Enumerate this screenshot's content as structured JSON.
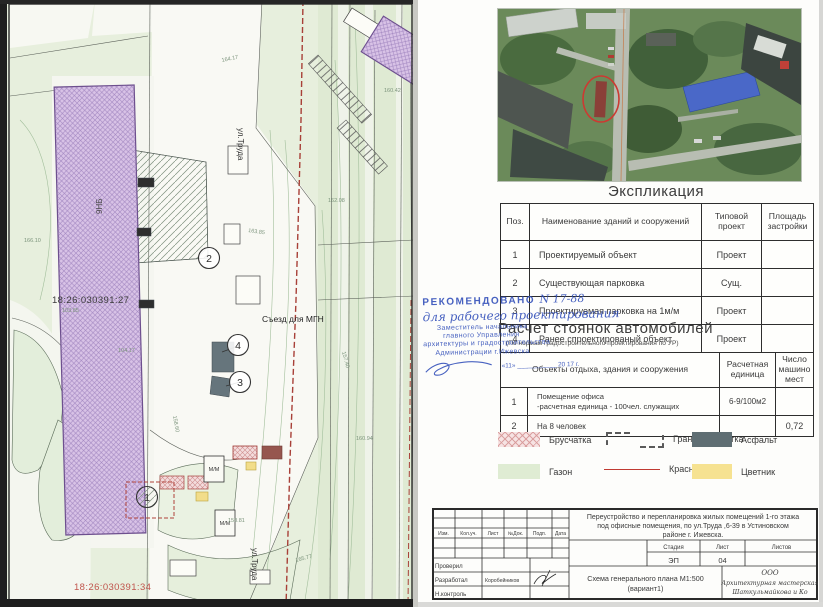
{
  "map": {
    "cadastral_number_left": "18:26:030391:27",
    "cadastral_number_bottom": "18:26:030391:34",
    "street_label": "ул.Труда",
    "street_label_2": "ул.Труда",
    "building_label": "9НБ",
    "ramp_label": "Съезд для МГН",
    "parking_space_label": "М/М",
    "parking_space_label_2": "М/М",
    "callout_1": "1",
    "callout_2": "2",
    "callout_3": "3",
    "callout_4": "4",
    "elevations": [
      "164.17",
      "163.85",
      "162.08",
      "157.40",
      "160.94",
      "158.60",
      "165.77",
      "104.17",
      "103.85",
      "158.81",
      "160.42",
      "166.10"
    ]
  },
  "explication": {
    "title": "Экспликация",
    "headers": [
      "Поз.",
      "Наименование зданий и сооружений",
      "Типовой проект",
      "Площадь застройки"
    ],
    "rows": [
      {
        "pos": "1",
        "name": "Проектируемый объект",
        "type": "Проект",
        "area": ""
      },
      {
        "pos": "2",
        "name": "Существующая парковка",
        "type": "Сущ.",
        "area": ""
      },
      {
        "pos": "3",
        "name": "Проектируемая парковка на 1м/м",
        "type": "Проект",
        "area": ""
      },
      {
        "pos": "4",
        "name": "Ранее спроектированый объект",
        "type": "Проект",
        "area": ""
      }
    ]
  },
  "approval_stamp": {
    "recommended": "РЕКОМЕНДОВАНО",
    "number": "N 17-88",
    "handwritten": "для рабочего проектирования",
    "line1": "Заместитель начальника",
    "line2": "главного Управления",
    "line3": "архитектуры и градостроительства",
    "line4": "Администрации г.Ижевска",
    "date_line": "«11» ___________ 20 17 г."
  },
  "parking_calc": {
    "title": "Расчет стоянок автомобилей",
    "subtitle": "(По нормам градостроительного проектирования по УР)",
    "header_objects": "Объекты отдыха, здания и сооружения",
    "header_unit": "Расчетная единица",
    "header_count": "Число машино мест",
    "rows": [
      {
        "pos": "1",
        "name_line1": "Помещение офиса",
        "name_line2": "-расчетная единица - 100чел. служащих",
        "unit": "6-9/100м2",
        "count": ""
      },
      {
        "pos": "2",
        "name_line1": "На 8  человек",
        "name_line2": "",
        "unit": "",
        "count": "0,72"
      }
    ]
  },
  "legend": {
    "paving": "Брусчатка",
    "boundary": "Границы участка",
    "asphalt": "Асфальт",
    "lawn": "Газон",
    "red_line": "Красная линия",
    "flowerbed": "Цветник"
  },
  "title_block": {
    "cols": [
      "Изм.",
      "Кол.уч.",
      "Лист",
      "№Док.",
      "Подп.",
      "Дата"
    ],
    "project_line_1": "Переустройство и перепланировка жилых помещений 1-го этажа",
    "project_line_2": "под офисные помещения, по ул.Труда ,6-39  в Устиновском",
    "project_line_3": "районе г. Ижевска.",
    "stage_label": "Стадия",
    "sheet_label": "Лист",
    "sheets_label": "Листов",
    "stage_value": "ЭП",
    "sheet_value": "04",
    "sheets_value": "",
    "role_1": "Проверил",
    "role_2": "Разработал",
    "role_3": "Н.контроль",
    "developer_name": "Коробейников",
    "scheme_title_1": "Схема генерального плана М1:500",
    "scheme_title_2": "(вариант1)",
    "company_form": "ООО",
    "company_name_1": "Архитектурная мастерская",
    "company_name_2": "Шаткульмайкова и Ко"
  }
}
